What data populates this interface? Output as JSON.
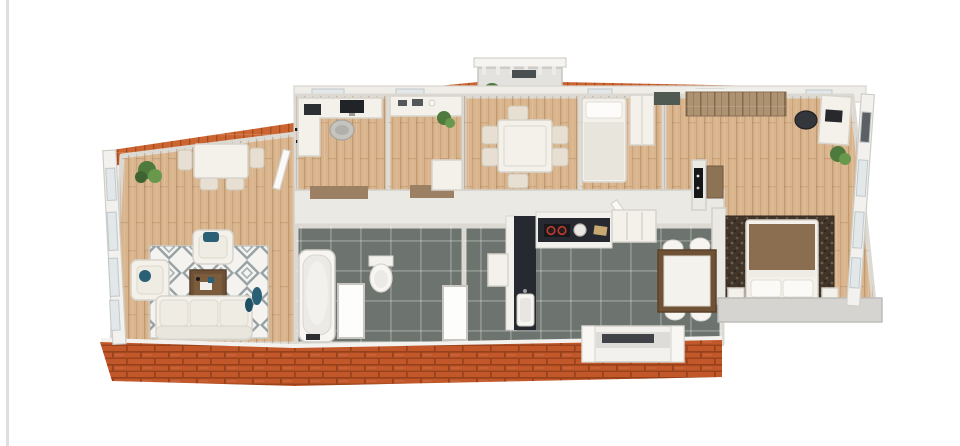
{
  "scene": {
    "title": "3D Floor Plan",
    "type": "isometric-3d-floor-plan",
    "description": "3D rendered apartment floor plan with terracotta roof eaves, wooden floors, dark tiled bathroom and kitchen, white walls and furniture"
  },
  "colors": {
    "background": "#ffffff",
    "page_edge": "#dedede",
    "roof_tile": "#cd6530",
    "roof_brick": "#c2582a",
    "wall_light": "#ebe9e4",
    "wood_floor": "#d9b48c",
    "tile_floor": "#6d7470",
    "rug_light": "#f4f3f0",
    "rug_diamond": "#98a2a4",
    "rug_dark": "#41352a",
    "accent_blue": "#2a6075",
    "bed_blanket": "#8b6e4f",
    "counter_dark": "#262a30",
    "closet_wood": "#ad9371",
    "table_wood": "#6f5236",
    "mat_brown": "#9b8063",
    "plant_green": "#4f7a3d",
    "stove_red": "#c03a2e",
    "entry_mat": "#4e5a52"
  },
  "rooms": [
    {
      "name": "living-room",
      "floor": "wood"
    },
    {
      "name": "office",
      "floor": "wood"
    },
    {
      "name": "storage-room",
      "floor": "wood"
    },
    {
      "name": "dining-room",
      "floor": "wood"
    },
    {
      "name": "small-bedroom",
      "floor": "wood"
    },
    {
      "name": "master-bedroom",
      "floor": "wood"
    },
    {
      "name": "bathroom",
      "floor": "dark-tile"
    },
    {
      "name": "kitchen",
      "floor": "dark-tile"
    },
    {
      "name": "balcony",
      "floor": "concrete"
    }
  ],
  "furniture": {
    "living_room": [
      "dining-table",
      "chairs",
      "plant",
      "armchair",
      "armchair",
      "diamond-rug",
      "coffee-table",
      "sofa",
      "blue-vase"
    ],
    "office": [
      "l-desk",
      "monitor",
      "printer",
      "office-chair",
      "wall-marks"
    ],
    "storage_room": [
      "counter",
      "small-appliances",
      "plant",
      "cabinet"
    ],
    "dining_room": [
      "dining-table",
      "six-chairs"
    ],
    "small_bedroom": [
      "single-bed",
      "wardrobe",
      "entry-mat"
    ],
    "master_bedroom": [
      "closet-row",
      "desk",
      "laptop",
      "desk-chair",
      "plant",
      "tv-panel",
      "brown-cabinet",
      "dark-rug",
      "double-bed",
      "nightstand",
      "nightstand"
    ],
    "bathroom": [
      "bathtub",
      "toilet",
      "bath-mat",
      "bath-mat"
    ],
    "kitchen": [
      "l-counter",
      "sink",
      "stove",
      "pot",
      "cutting-board",
      "tall-cabinet",
      "white-cabinet",
      "dining-table",
      "four-chairs",
      "bay-window"
    ],
    "balcony": [
      "railing",
      "plant",
      "doorway-mat"
    ]
  }
}
